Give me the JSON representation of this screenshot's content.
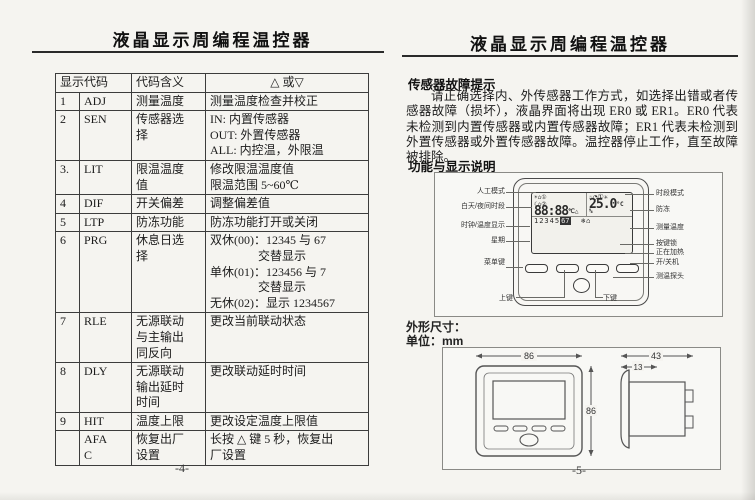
{
  "left": {
    "title": "液晶显示周编程温控器",
    "page_number": "-4-",
    "table": {
      "headers": [
        "显示代码",
        "代码含义",
        "△ 或▽"
      ],
      "rows": [
        {
          "num": "1",
          "code": "ADJ",
          "meaning": "测量温度",
          "action": "测量温度检查并校正"
        },
        {
          "num": "2",
          "code": "SEN",
          "meaning": "传感器选\n择",
          "action": "IN: 内置传感器\nOUT: 外置传感器\nALL: 内控温，外限温"
        },
        {
          "num": "3.",
          "code": "LIT",
          "meaning": "限温温度\n值",
          "action": "修改限温温度值\n限温范围 5~60℃"
        },
        {
          "num": "4",
          "code": "DIF",
          "meaning": "开关偏差",
          "action": "调整偏差值"
        },
        {
          "num": "5",
          "code": "LTP",
          "meaning": "防冻功能",
          "action": "防冻功能打开或关闭"
        },
        {
          "num": "6",
          "code": "PRG",
          "meaning": "休息日选\n择",
          "action": "双休(00)：12345 与 67\n　　　　交替显示\n单休(01)：123456 与 7\n　　　　交替显示\n无休(02)：显示 1234567"
        },
        {
          "num": "7",
          "code": "RLE",
          "meaning": "无源联动\n与主输出\n同反向",
          "action": "更改当前联动状态"
        },
        {
          "num": "8",
          "code": "DLY",
          "meaning": "无源联动\n输出延时\n时间",
          "action": "更改联动延时时间"
        },
        {
          "num": "9",
          "code": "HIT",
          "meaning": "温度上限",
          "action": "更改设定温度上限值"
        },
        {
          "num": "",
          "code": "AFA\nC",
          "meaning": "恢复出厂\n设置",
          "action": "长按 △ 键 5 秒，恢复出\n厂设置"
        }
      ]
    }
  },
  "right": {
    "title": "液晶显示周编程温控器",
    "page_number": "-5-",
    "fault": {
      "heading": "传感器故障提示",
      "text": "请正确选择内、外传感器工作方式，如选择出错或者传感器故障（损坏），液晶界面将出现 ER0 或 ER1。ER0 代表未检测到内置传感器或内置传感器故障；ER1 代表未检测到外置传感器或外置传感器故障。温控器停止工作，直至故障被排除。"
    },
    "function_heading": "功能与显示说明",
    "diagram": {
      "left_labels": [
        "人工模式",
        "白天/夜间时段",
        "时钟/温度显示",
        "星期",
        "菜单键"
      ],
      "right_labels": [
        "时段模式",
        "防冻",
        "测量温度",
        "按键锁",
        "正在加热",
        "开/关机",
        "测温探头"
      ],
      "bottom_labels": [
        "上键",
        "下键"
      ],
      "lcd": {
        "icons": {
          "sun": "☀",
          "house1": "⌂",
          "period1": "①",
          "moon": "☾",
          "house2": "⌂",
          "period2": "②",
          "hand": "♨",
          "clock": "◔",
          "timer": "①",
          "fan": "✳",
          "snow": "❄",
          "lock": "⌂"
        },
        "time": "88:88",
        "time_unit": "℃△",
        "temp": "25.0",
        "temp_unit": "°C",
        "temp_pct": "%",
        "week": "12345",
        "week_hi": "67"
      }
    },
    "dims": {
      "caption": "外形尺寸：",
      "unit_line": "单位：mm",
      "front_width": "86",
      "front_height": "86",
      "side_depth": "43",
      "side_front": "13"
    }
  }
}
